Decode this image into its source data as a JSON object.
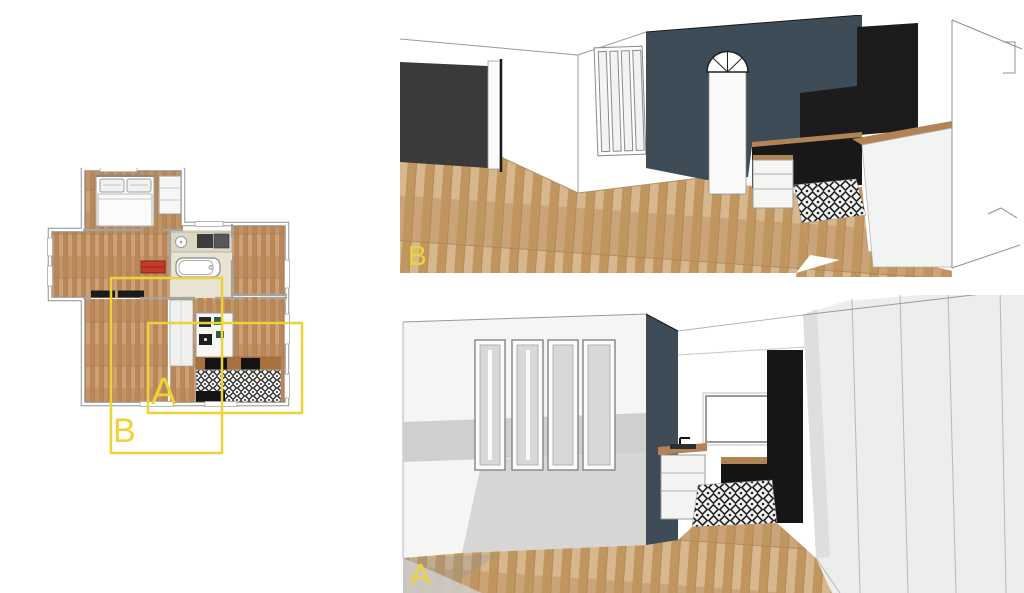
{
  "page": {
    "width": 1024,
    "height": 593,
    "background": "#ffffff"
  },
  "floor_plan": {
    "description": "apartment floor plan with camera regions",
    "overlay": {
      "region_a_label": "A",
      "region_b_label": "B",
      "accent_color": "#eed338"
    }
  },
  "views": {
    "top": {
      "id": "view-b",
      "label": "B"
    },
    "bottom": {
      "id": "view-a",
      "label": "A"
    }
  },
  "palette": {
    "navy_wall": "#3e4c57",
    "dark_opening": "#3a3a3a",
    "black_cabinet": "#1b1b1b",
    "wood_floor_3d": "#cba379",
    "plan_wood": "#c29465",
    "counter_wood": "#b28355",
    "plan_counter_brown": "#a9713d",
    "tile_white": "#f4f4f2",
    "tile_black": "#242424",
    "red_accent": "#c2392e",
    "label_yellow": "#eed338",
    "shadow_grey": "#d2d2d0"
  }
}
